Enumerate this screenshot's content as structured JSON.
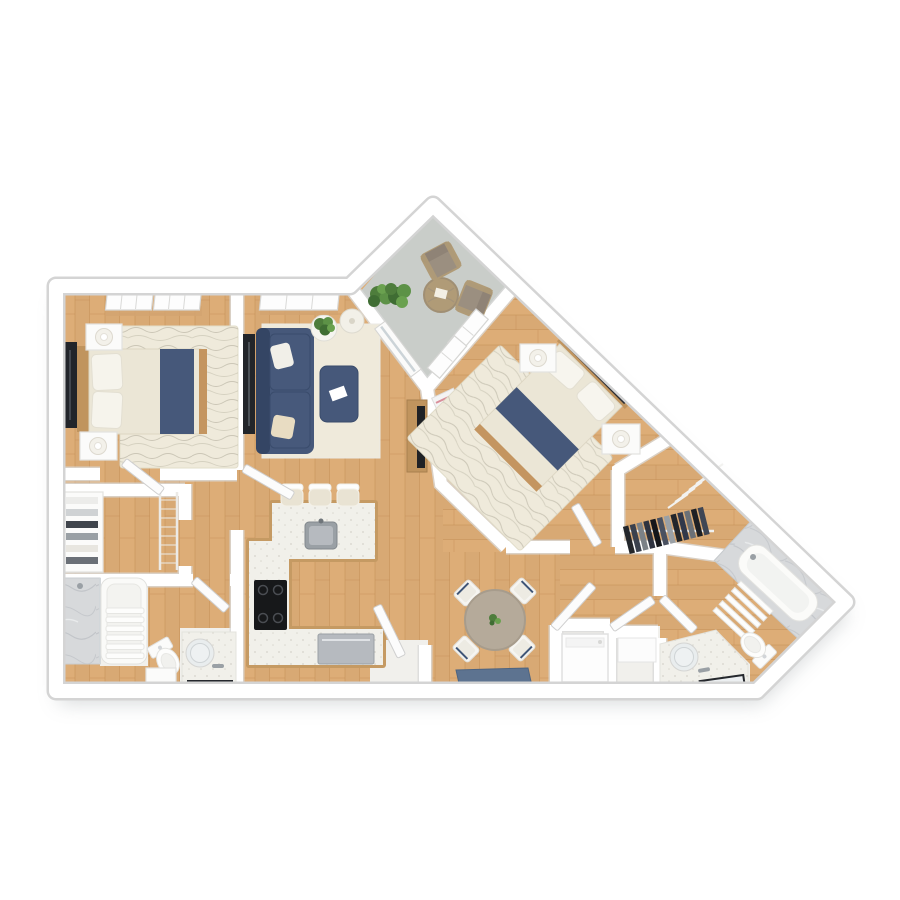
{
  "scene": {
    "type": "3d-floor-plan-render",
    "view": "top-down",
    "background": "#ffffff",
    "rooms_count": 13
  },
  "palette": {
    "wood_floor": "#ddad77",
    "plank_line": "#c08c52",
    "wall": "#ffffff",
    "wall_edge": "#d8d8d8",
    "balcony_floor": "#c9cdc9",
    "navy": "#46587a",
    "navy_dark": "#36496b",
    "bedding_cream": "#ebe6d6",
    "rug": "#efeadb",
    "rug_line": "#b2ad9c",
    "counter_white": "#f1f0ea",
    "cabinet_wood": "#c59a63",
    "marble": "#d7d9db",
    "stainless": "#b6babf",
    "cooktop_black": "#17181a",
    "dining_table": "#b5aa9a",
    "patio_taupe": "#9b8f80",
    "patio_frame": "#b09b77",
    "plant_green": "#4e7d3c",
    "doormat_blue": "#5d7390",
    "tile_white": "#f1f0ec",
    "furniture_wood": "#c0945e",
    "dark_item": "#22252a"
  },
  "rooms": [
    {
      "name": "bedroom-1",
      "items": [
        "double-bed",
        "wood-headboard",
        "navy-bed-runner",
        "pillows",
        "media-dresser",
        "nightstand",
        "nightstand",
        "table-lamp",
        "table-lamp",
        "area-rug",
        "window",
        "window",
        "door"
      ]
    },
    {
      "name": "living-room",
      "items": [
        "navy-sofa",
        "throw-pillows",
        "tv-console",
        "ottoman-coffee-table",
        "magazine",
        "area-rug",
        "side-table",
        "houseplant",
        "floor-lamp",
        "corner-plant",
        "window",
        "media-bench",
        "magazine-stack"
      ]
    },
    {
      "name": "balcony",
      "items": [
        "bistro-table",
        "patio-chair",
        "patio-chair",
        "potted-plant",
        "sliding-glass-door"
      ]
    },
    {
      "name": "bedroom-2",
      "items": [
        "double-bed",
        "wood-headboard",
        "navy-bed-runner",
        "pillows",
        "nightstand",
        "nightstand",
        "table-lamp",
        "table-lamp",
        "area-rug",
        "window",
        "window",
        "door"
      ]
    },
    {
      "name": "walk-in-closet-1",
      "items": [
        "linen-shelves",
        "wire-shelving"
      ]
    },
    {
      "name": "bathroom-1",
      "items": [
        "marble-shower",
        "bathtub",
        "towel-shelf",
        "toilet",
        "storage-cabinet",
        "vanity-sink",
        "round-mirror",
        "dark-tray",
        "door"
      ]
    },
    {
      "name": "kitchen",
      "items": [
        "u-shaped-counter",
        "sink",
        "faucet",
        "cooktop",
        "stainless-dishwasher",
        "bar-stool",
        "bar-stool",
        "bar-stool"
      ]
    },
    {
      "name": "dining-area",
      "items": [
        "round-dining-table",
        "centerpiece-plant",
        "dining-chair",
        "dining-chair",
        "dining-chair",
        "dining-chair"
      ]
    },
    {
      "name": "entry",
      "items": [
        "front-door",
        "doormat"
      ]
    },
    {
      "name": "hallway",
      "items": [
        "open-door",
        "open-door",
        "open-door"
      ]
    },
    {
      "name": "laundry-closet",
      "items": [
        "washer-dryer",
        "storage-shelf"
      ]
    },
    {
      "name": "walk-in-closet-2",
      "items": [
        "clothes-rod",
        "hanging-clothes",
        "empty-hangers"
      ]
    },
    {
      "name": "bathroom-2",
      "items": [
        "bathtub",
        "marble-deck",
        "towel-shelf",
        "toilet",
        "vanity-sink",
        "round-mirror",
        "dark-tray",
        "door"
      ]
    }
  ]
}
